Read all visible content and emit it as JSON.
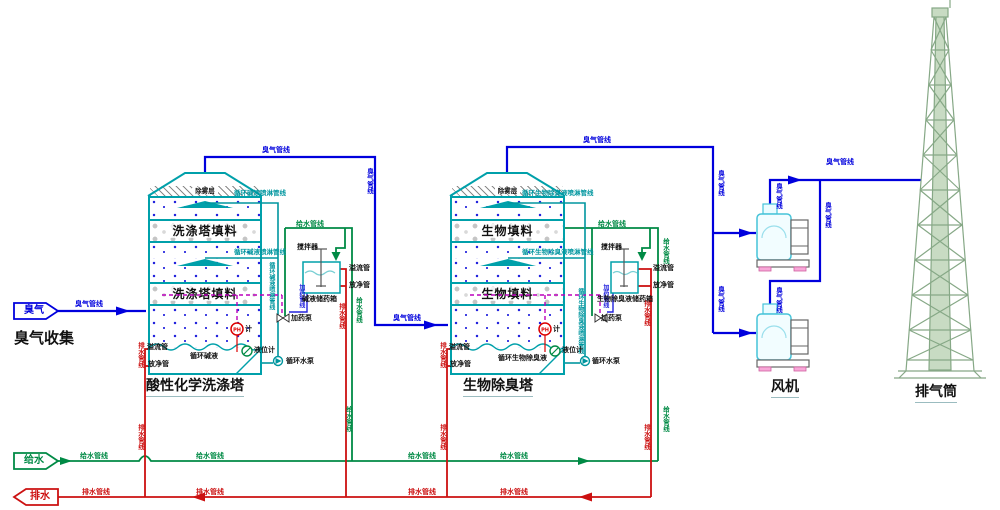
{
  "sources": {
    "odor_badge": "臭气",
    "odor_collection_title": "臭气收集",
    "supply_badge": "给水",
    "drain_badge": "排水"
  },
  "pipelines": {
    "odor": "臭气管线",
    "supply": "给水管线",
    "drain": "排水管线",
    "dosing": "加药管线",
    "tower1_spray": "循环碱液喷淋管线",
    "tower2_spray": "循环生物除臭液喷淋管线"
  },
  "tower1": {
    "name": "酸性化学洗涤塔",
    "demister": "除雾层",
    "packing": "洗涤塔填料",
    "sump_liquid": "循环碱液",
    "tank": "碱液储药箱",
    "agitator": "搅拌器",
    "overflow": "溢流管",
    "drain_valve": "放净管",
    "dosing_pump": "加药泵",
    "circ_pump": "循环水泵",
    "ph_label": "PH",
    "ph_suffix": "计",
    "level_gauge": "液位计"
  },
  "tower2": {
    "name": "生物除臭塔",
    "demister": "除雾层",
    "packing": "生物填料",
    "sump_liquid": "循环生物除臭液",
    "tank": "生物除臭液储药箱",
    "agitator": "搅拌器",
    "overflow": "溢流管",
    "drain_valve": "放净管",
    "dosing_pump": "加药泵",
    "circ_pump": "循环水泵",
    "ph_label": "PH",
    "ph_suffix": "计",
    "level_gauge": "液位计"
  },
  "fan": {
    "name": "风机"
  },
  "stack": {
    "name": "排气筒"
  },
  "colors": {
    "odor_line": "#0000dd",
    "supply_line": "#008a45",
    "drain_line": "#cc1111",
    "equipment": "#00a0aa",
    "dosing_line": "#bb00bb",
    "stack_green": "#86a886"
  }
}
